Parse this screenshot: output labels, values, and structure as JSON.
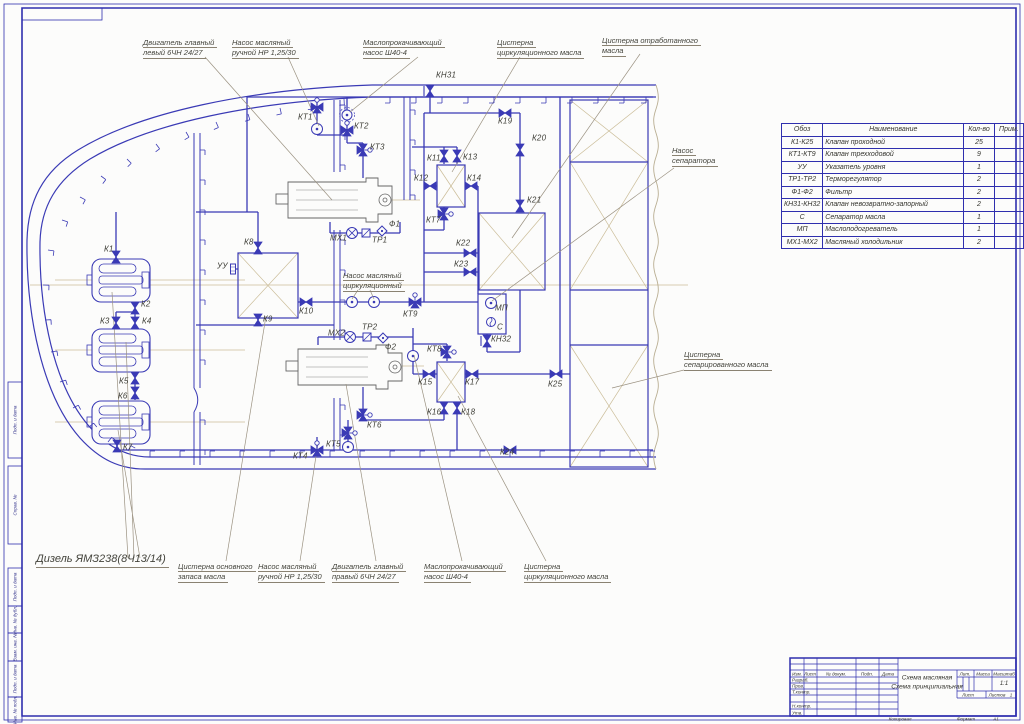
{
  "sheet": {
    "kind": "Принципиальная схема масляной системы судна (чертеж ГОСТ)"
  },
  "diagram": {
    "callouts": [
      {
        "lines": [
          "Двигатель главный",
          "левый 6ЧН 24/27"
        ],
        "x": 143,
        "y": 38,
        "big": false
      },
      {
        "lines": [
          "Насос масляный",
          "ручной НР 1,25/30"
        ],
        "x": 232,
        "y": 38,
        "big": false
      },
      {
        "lines": [
          "Маслопрокачивающий",
          "насос Ш40-4"
        ],
        "x": 363,
        "y": 38,
        "big": false
      },
      {
        "lines": [
          "Цистерна",
          "циркуляционного масла"
        ],
        "x": 497,
        "y": 38,
        "big": false
      },
      {
        "lines": [
          "Цистерна отработанного",
          "масла"
        ],
        "x": 602,
        "y": 36,
        "big": false
      },
      {
        "lines": [
          "Насос",
          "сепаратора"
        ],
        "x": 672,
        "y": 146,
        "big": false
      },
      {
        "lines": [
          "Цистерна",
          "сепарированного масла"
        ],
        "x": 684,
        "y": 350,
        "big": false
      },
      {
        "lines": [
          "Дизель ЯМЗ238(8Ч13/14)"
        ],
        "x": 36,
        "y": 553,
        "big": true
      },
      {
        "lines": [
          "Цистерна основного",
          "запаса масла"
        ],
        "x": 178,
        "y": 562,
        "big": false
      },
      {
        "lines": [
          "Насос масляный",
          "ручной НР 1,25/30"
        ],
        "x": 258,
        "y": 562,
        "big": false
      },
      {
        "lines": [
          "Двигатель главный",
          "правый 6ЧН 24/27"
        ],
        "x": 332,
        "y": 562,
        "big": false
      },
      {
        "lines": [
          "Маслопрокачивающий",
          "насос Ш40-4"
        ],
        "x": 424,
        "y": 562,
        "big": false
      },
      {
        "lines": [
          "Цистерна",
          "циркуляционного масла"
        ],
        "x": 524,
        "y": 562,
        "big": false
      },
      {
        "lines": [
          "Насос масляный",
          "циркуляционный"
        ],
        "x": 343,
        "y": 271,
        "big": false
      }
    ],
    "components": [
      {
        "label": "К1",
        "lx": 104,
        "ly": 249,
        "glyph": "v",
        "gx": 116,
        "gy": 257,
        "rot": 90
      },
      {
        "label": "К2",
        "lx": 141,
        "ly": 304,
        "glyph": "v",
        "gx": 135,
        "gy": 308,
        "rot": 90
      },
      {
        "label": "К3",
        "lx": 100,
        "ly": 321,
        "glyph": "v",
        "gx": 116,
        "gy": 323,
        "rot": 90
      },
      {
        "label": "К4",
        "lx": 142,
        "ly": 321,
        "glyph": "v",
        "gx": 135,
        "gy": 323,
        "rot": 90
      },
      {
        "label": "К5",
        "lx": 119,
        "ly": 381,
        "glyph": "v",
        "gx": 135,
        "gy": 378,
        "rot": 90
      },
      {
        "label": "К6",
        "lx": 118,
        "ly": 396,
        "glyph": "v",
        "gx": 135,
        "gy": 393,
        "rot": 90
      },
      {
        "label": "К7",
        "lx": 123,
        "ly": 447,
        "glyph": "v",
        "gx": 117,
        "gy": 446,
        "rot": 90
      },
      {
        "label": "К8",
        "lx": 244,
        "ly": 242,
        "glyph": "v",
        "gx": 258,
        "gy": 248,
        "rot": 90
      },
      {
        "label": "К9",
        "lx": 263,
        "ly": 319,
        "glyph": "v",
        "gx": 258,
        "gy": 320,
        "rot": 90
      },
      {
        "label": "К10",
        "lx": 299,
        "ly": 311,
        "glyph": "v",
        "gx": 306,
        "gy": 302,
        "rot": 0
      },
      {
        "label": "К11",
        "lx": 427,
        "ly": 158,
        "glyph": "v",
        "gx": 444,
        "gy": 156,
        "rot": 90
      },
      {
        "label": "К12",
        "lx": 414,
        "ly": 178,
        "glyph": "v",
        "gx": 430,
        "gy": 186,
        "rot": 0
      },
      {
        "label": "К13",
        "lx": 463,
        "ly": 157,
        "glyph": "v",
        "gx": 457,
        "gy": 156,
        "rot": 90
      },
      {
        "label": "К14",
        "lx": 467,
        "ly": 178,
        "glyph": "v",
        "gx": 471,
        "gy": 186,
        "rot": 0
      },
      {
        "label": "К15",
        "lx": 418,
        "ly": 382,
        "glyph": "v",
        "gx": 429,
        "gy": 374,
        "rot": 0
      },
      {
        "label": "К16",
        "lx": 427,
        "ly": 412,
        "glyph": "v",
        "gx": 444,
        "gy": 408,
        "rot": 90
      },
      {
        "label": "К17",
        "lx": 465,
        "ly": 382,
        "glyph": "v",
        "gx": 472,
        "gy": 374,
        "rot": 0
      },
      {
        "label": "К18",
        "lx": 461,
        "ly": 412,
        "glyph": "v",
        "gx": 457,
        "gy": 408,
        "rot": 90
      },
      {
        "label": "К19",
        "lx": 498,
        "ly": 121,
        "glyph": "v",
        "gx": 505,
        "gy": 113,
        "rot": 0
      },
      {
        "label": "К20",
        "lx": 532,
        "ly": 138,
        "glyph": "v",
        "gx": 520,
        "gy": 150,
        "rot": 90
      },
      {
        "label": "К21",
        "lx": 527,
        "ly": 200,
        "glyph": "v",
        "gx": 520,
        "gy": 206,
        "rot": 90
      },
      {
        "label": "К22",
        "lx": 456,
        "ly": 243,
        "glyph": "v",
        "gx": 470,
        "gy": 253,
        "rot": 0
      },
      {
        "label": "К23",
        "lx": 454,
        "ly": 264,
        "glyph": "v",
        "gx": 470,
        "gy": 272,
        "rot": 0
      },
      {
        "label": "К24",
        "lx": 500,
        "ly": 452,
        "glyph": "v",
        "gx": 510,
        "gy": 450,
        "rot": 0
      },
      {
        "label": "К25",
        "lx": 548,
        "ly": 384,
        "glyph": "v",
        "gx": 556,
        "gy": 374,
        "rot": 0
      },
      {
        "label": "КТ1",
        "lx": 298,
        "ly": 117,
        "glyph": "v3",
        "gx": 317,
        "gy": 107,
        "rot": 0
      },
      {
        "label": "КТ2",
        "lx": 354,
        "ly": 126,
        "glyph": "v3",
        "gx": 347,
        "gy": 130,
        "rot": 0
      },
      {
        "label": "КТ3",
        "lx": 370,
        "ly": 147,
        "glyph": "v3",
        "gx": 363,
        "gy": 150,
        "rot": 90
      },
      {
        "label": "КТ4",
        "lx": 293,
        "ly": 456,
        "glyph": "v3",
        "gx": 317,
        "gy": 450,
        "rot": 0
      },
      {
        "label": "КТ5",
        "lx": 326,
        "ly": 444,
        "glyph": "v3",
        "gx": 348,
        "gy": 433,
        "rot": 90
      },
      {
        "label": "КТ6",
        "lx": 367,
        "ly": 425,
        "glyph": "v3",
        "gx": 363,
        "gy": 415,
        "rot": 90
      },
      {
        "label": "КТ7",
        "lx": 426,
        "ly": 220,
        "glyph": "v3",
        "gx": 444,
        "gy": 214,
        "rot": 90
      },
      {
        "label": "КТ8",
        "lx": 427,
        "ly": 349,
        "glyph": "v3",
        "gx": 447,
        "gy": 352,
        "rot": 90
      },
      {
        "label": "КТ9",
        "lx": 403,
        "ly": 314,
        "glyph": "v3",
        "gx": 415,
        "gy": 302,
        "rot": 0
      },
      {
        "label": "КН31",
        "lx": 436,
        "ly": 75,
        "glyph": "ch",
        "gx": 430,
        "gy": 91,
        "rot": 90
      },
      {
        "label": "КН32",
        "lx": 491,
        "ly": 339,
        "glyph": "ch",
        "gx": 487,
        "gy": 341,
        "rot": 90
      },
      {
        "label": "МХ1",
        "lx": 330,
        "ly": 238,
        "glyph": "cool",
        "gx": 352,
        "gy": 233,
        "rot": 0
      },
      {
        "label": "МХ2",
        "lx": 328,
        "ly": 333,
        "glyph": "cool",
        "gx": 350,
        "gy": 337,
        "rot": 0
      },
      {
        "label": "ТР1",
        "lx": 372,
        "ly": 240,
        "glyph": "th",
        "gx": 366,
        "gy": 233,
        "rot": 0
      },
      {
        "label": "ТР2",
        "lx": 362,
        "ly": 327,
        "glyph": "th",
        "gx": 367,
        "gy": 337,
        "rot": 0
      },
      {
        "label": "Ф1",
        "lx": 389,
        "ly": 224,
        "glyph": "f",
        "gx": 382,
        "gy": 231,
        "rot": 0
      },
      {
        "label": "Ф2",
        "lx": 385,
        "ly": 347,
        "glyph": "f",
        "gx": 383,
        "gy": 338,
        "rot": 0
      },
      {
        "label": "УУ",
        "lx": 217,
        "ly": 266,
        "glyph": "uu",
        "gx": 233,
        "gy": 269,
        "rot": 0
      },
      {
        "label": "МП",
        "lx": 495,
        "ly": 308,
        "glyph": "none",
        "gx": 0,
        "gy": 0,
        "rot": 0
      },
      {
        "label": "С",
        "lx": 497,
        "ly": 327,
        "glyph": "none",
        "gx": 0,
        "gy": 0,
        "rot": 0
      }
    ]
  },
  "parts_table": {
    "headers": [
      "Обоз",
      "Наименование",
      "Кол-во",
      "Прим."
    ],
    "rows": [
      [
        "К1-К25",
        "Клапан проходной",
        "25",
        ""
      ],
      [
        "КТ1-КТ9",
        "Клапан трехходовой",
        "9",
        ""
      ],
      [
        "УУ",
        "Указатель уровня",
        "1",
        ""
      ],
      [
        "ТР1-ТР2",
        "Терморегулятор",
        "2",
        ""
      ],
      [
        "Ф1-Ф2",
        "Фильтр",
        "2",
        ""
      ],
      [
        "КН31-КН32",
        "Клапан невозвратно-запорный",
        "2",
        ""
      ],
      [
        "С",
        "Сепаратор масла",
        "1",
        ""
      ],
      [
        "МП",
        "Маслоподогреватель",
        "1",
        ""
      ],
      [
        "МХ1-МХ2",
        "Масляный холодильник",
        "2",
        ""
      ]
    ]
  },
  "title_block": {
    "title_line1": "Схема масляная",
    "title_line2": "Схема принципиальная",
    "col_izm": "Изм.",
    "col_list": "Лист",
    "col_doc": "№ докум.",
    "col_podp": "Подп.",
    "col_data": "Дата",
    "row_razrab": "Разраб.",
    "row_prov": "Пров.",
    "row_tkontr": "Т.контр.",
    "row_nkontr": "Н.контр.",
    "row_utv": "Утв.",
    "lit": "Лит.",
    "massa": "Масса",
    "masshtab": "Масштаб",
    "scale_value": "1:1",
    "list_label": "Лист",
    "listov_label": "Листов",
    "listov_value": "1",
    "kopiroval": "Копировал",
    "format_label": "Формат",
    "format_value": "А1"
  },
  "frame": {
    "left_labels": [
      "Подп. и дата",
      "Справ. №",
      "Подп. и дата",
      "Инв. № дубл.",
      "Взам. инв. №",
      "Подп. и дата",
      "Инв. № подл."
    ]
  },
  "colors": {
    "line_blue": "#3a3ab5",
    "frame_blue": "#2f2fae",
    "construction_tan": "#cbbd99",
    "leader_gray": "#9a9180",
    "text_dark": "#3e3e37"
  }
}
